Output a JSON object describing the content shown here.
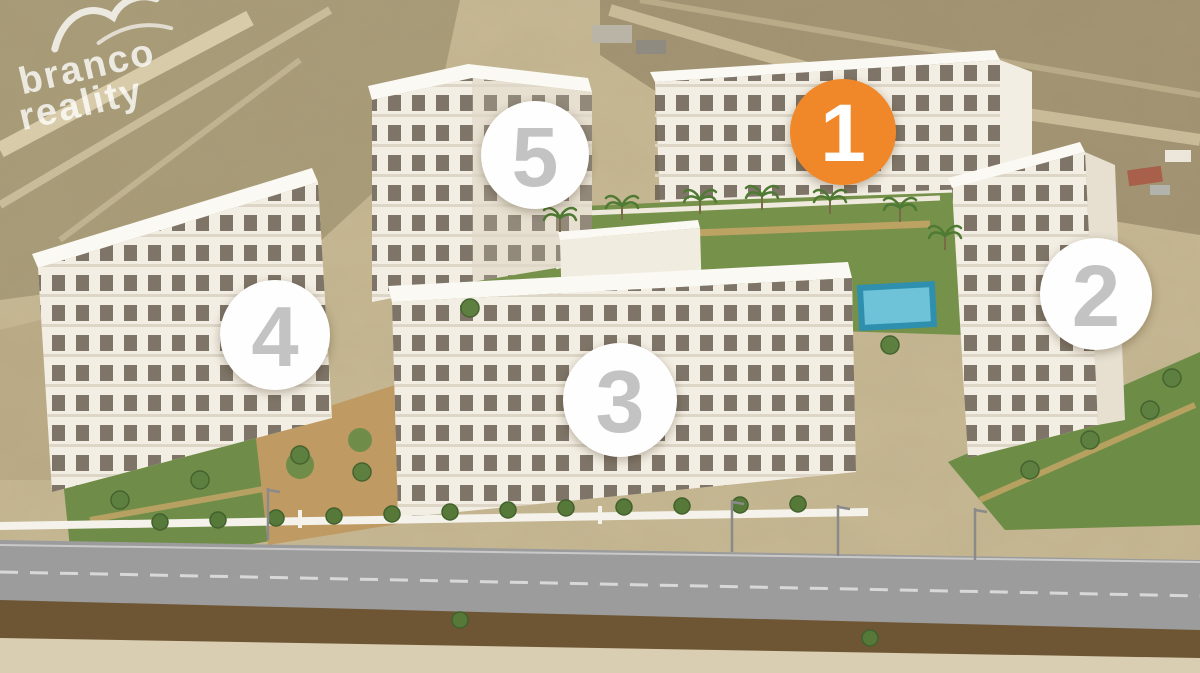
{
  "watermark": {
    "line1": "branco",
    "line2": "reality"
  },
  "markers": [
    {
      "label": "1",
      "x": 843,
      "y": 132,
      "r": 53,
      "variant": "highlighted",
      "bg": "#F0882A",
      "fg": "#FFFFFF"
    },
    {
      "label": "2",
      "x": 1096,
      "y": 294,
      "r": 56,
      "variant": "default",
      "bg": "#FEFEFE",
      "fg": "#C3C3C3"
    },
    {
      "label": "3",
      "x": 620,
      "y": 400,
      "r": 57,
      "variant": "default",
      "bg": "#FEFEFE",
      "fg": "#C3C3C3"
    },
    {
      "label": "4",
      "x": 275,
      "y": 335,
      "r": 55,
      "variant": "default",
      "bg": "#FEFEFE",
      "fg": "#C3C3C3"
    },
    {
      "label": "5",
      "x": 535,
      "y": 155,
      "r": 54,
      "variant": "default",
      "bg": "#FEFEFE",
      "fg": "#C3C3C3"
    }
  ],
  "colors": {
    "accent_orange": "#F0882A",
    "marker_white": "#FEFEFE",
    "marker_number_gray": "#C3C3C3",
    "sand": "#C7B894",
    "lawn_green": "#75914A",
    "pool_blue": "#2E8FAE",
    "road_gray": "#9C9C9C"
  }
}
